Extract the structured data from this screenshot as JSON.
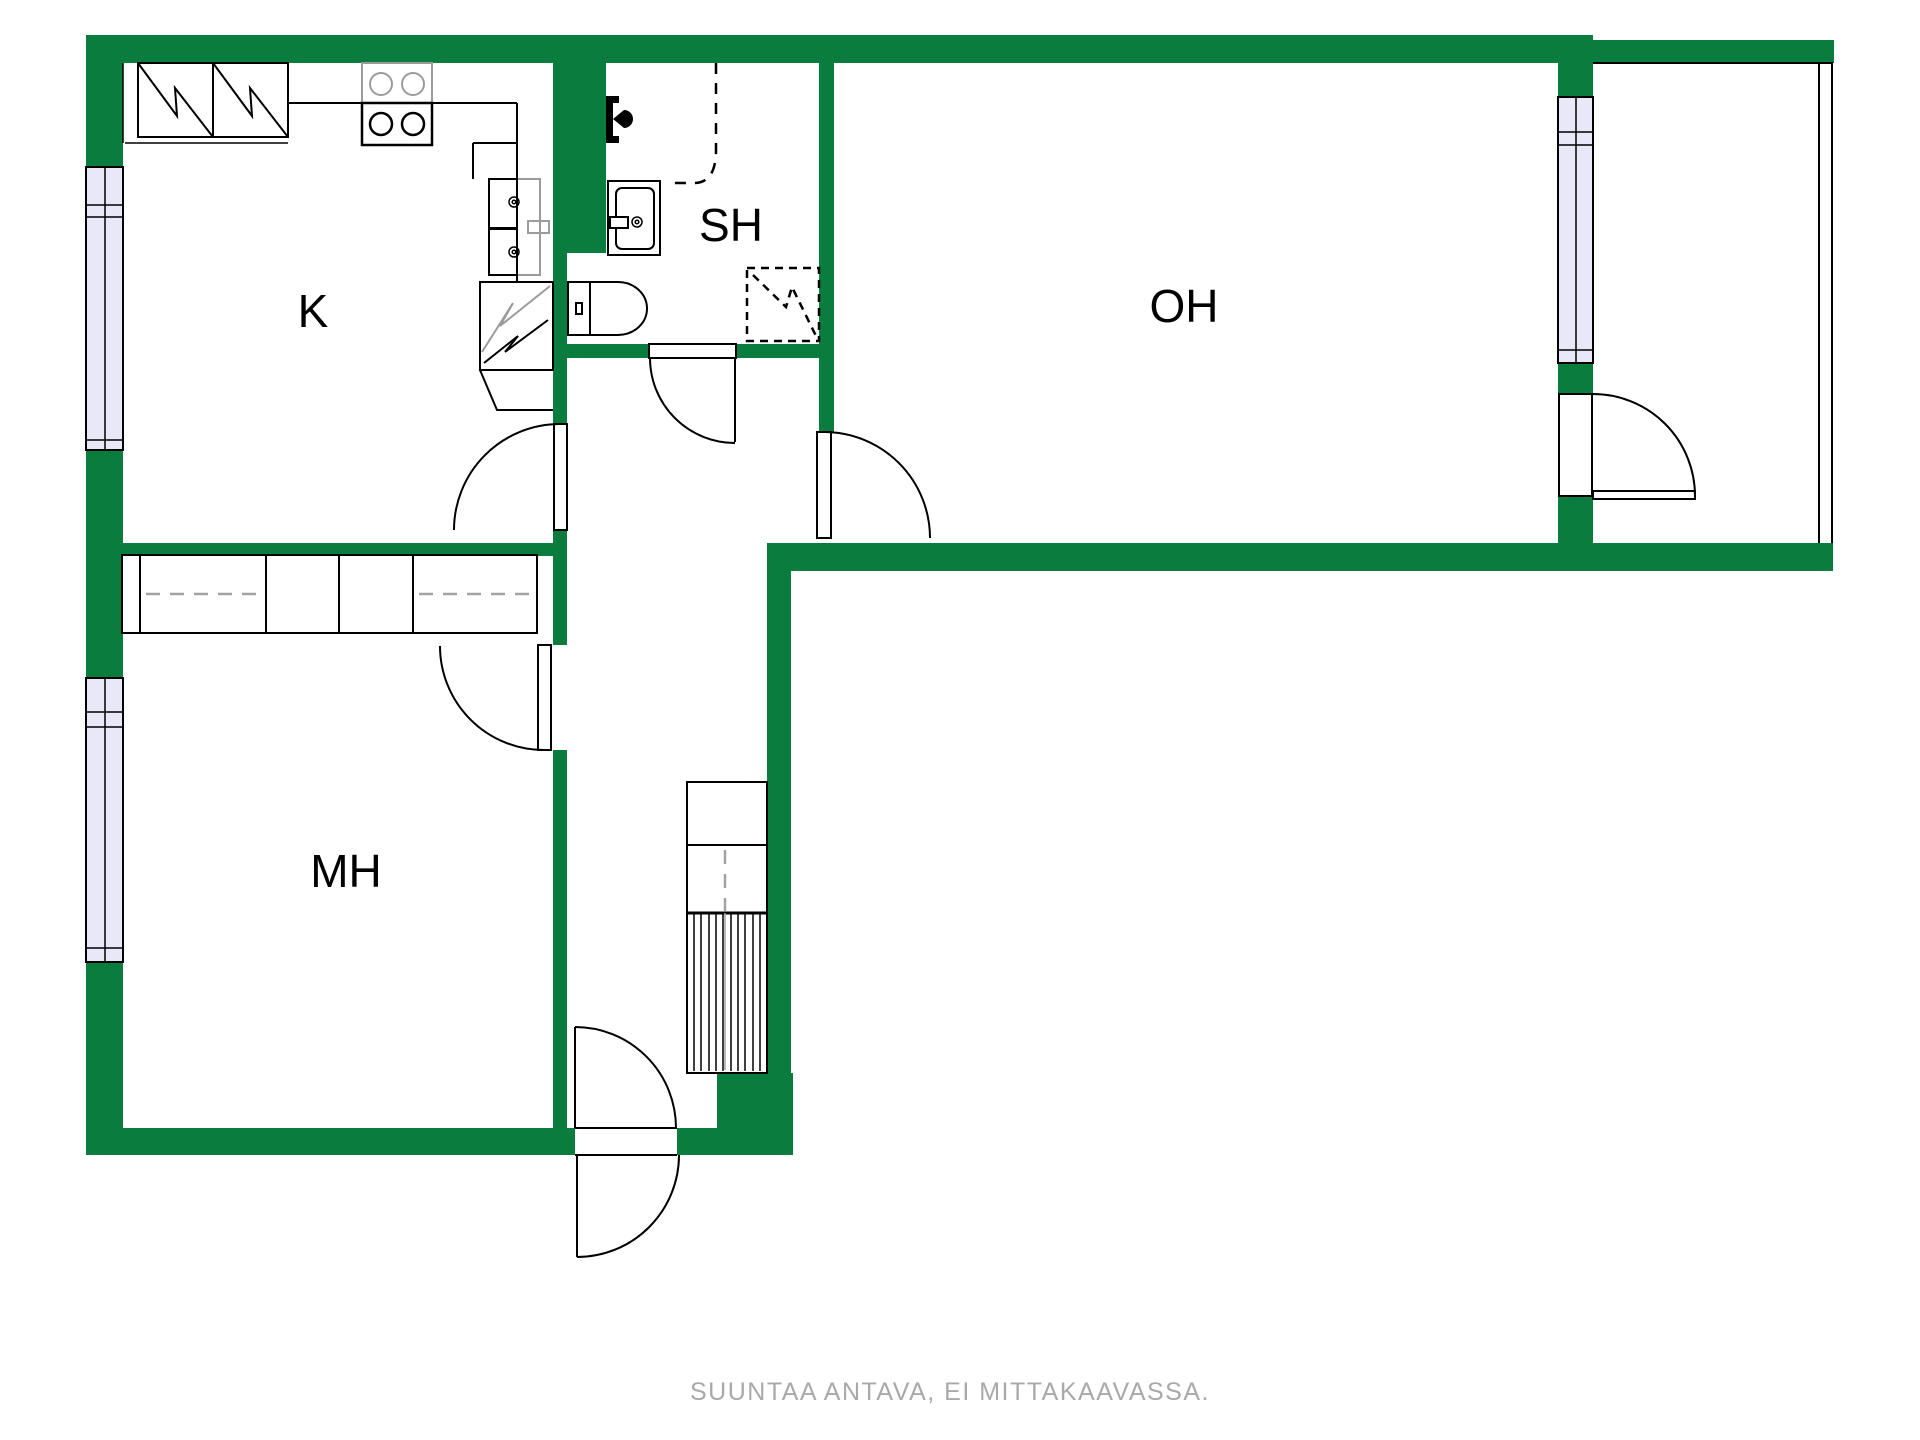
{
  "plan": {
    "rooms": [
      {
        "id": "kitchen",
        "label": "K"
      },
      {
        "id": "shower_room",
        "label": "SH"
      },
      {
        "id": "living_room",
        "label": "OH"
      },
      {
        "id": "bedroom",
        "label": "MH"
      }
    ],
    "caption": "SUUNTAA ANTAVA, EI MITTAKAAVASSA.",
    "icons": [
      "fridge-freezer-icon",
      "stove-icon",
      "kitchen-sink-icon",
      "corner-cabinet-icon",
      "shower-icon",
      "washbasin-icon",
      "toilet-icon",
      "washing-machine-reservation-icon",
      "stairs-icon",
      "wardrobe-icon",
      "door-arc-icon",
      "window-icon",
      "balcony-railing-icon"
    ]
  },
  "colors": {
    "wall_green": "#0a7c3d",
    "window_lavender": "#e8e8f8",
    "ink": "#000000",
    "fixture_gray": "#9b9b9b",
    "dash_gray": "#a3a3a3",
    "caption_gray": "#a9a9a9",
    "background": "#ffffff"
  }
}
